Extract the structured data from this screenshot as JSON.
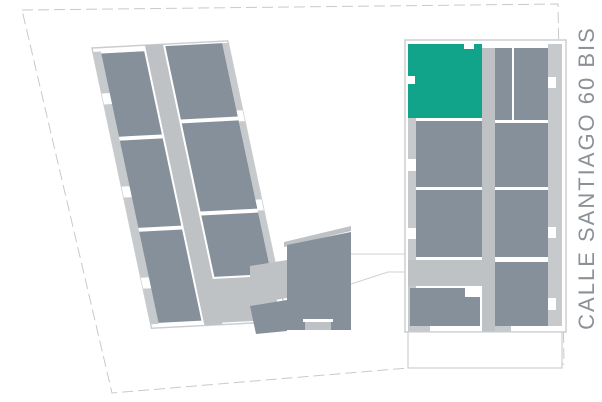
{
  "street": {
    "label": "CALLE SANTIAGO 60 BIS"
  },
  "colors": {
    "background": "#FFFFFF",
    "unit": "#86909A",
    "unit_highlight": "#12A38B",
    "circulation": "#BFC2C4",
    "edge_strip": "#C7CACC",
    "building_outline": "#CBCED0",
    "boundary_line": "#C9C9C9",
    "connector_line": "#CFD2D3",
    "label_text": "#8B9196"
  }
}
